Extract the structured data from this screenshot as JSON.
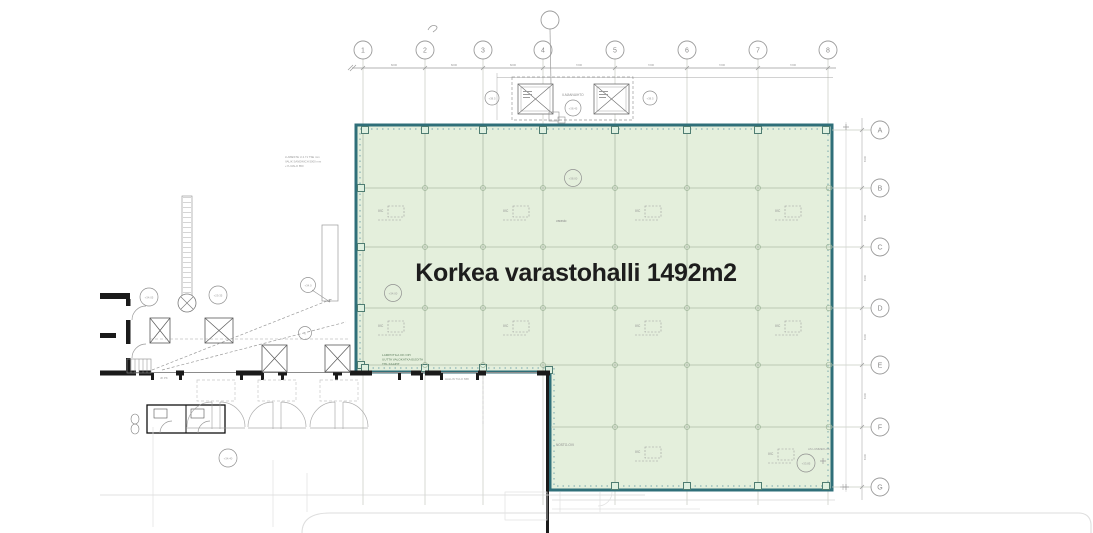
{
  "plan": {
    "highlight_label": "Korkea varastohalli 1492m2",
    "highlight_fill": "#e4efdc",
    "highlight_border": "#2f6f79",
    "iv_unit_label": "IVC"
  },
  "grid": {
    "top_labels": [
      "1",
      "2",
      "3",
      "4",
      "5",
      "6",
      "7",
      "8"
    ],
    "aux_label": "",
    "side_labels": [
      "A",
      "B",
      "C",
      "D",
      "E",
      "F",
      "G"
    ]
  },
  "dimensions": {
    "top": [
      "6000",
      "6000",
      "6000",
      "7200",
      "7200",
      "7200",
      "7200"
    ],
    "right": [
      "8100",
      "8100",
      "8100",
      "8100",
      "8100",
      "8100"
    ]
  },
  "elevations": {
    "roof_center": "+38.45",
    "roof_left": "+38.5",
    "roof_right": "+38.5",
    "hall_upper": "+38.00",
    "hall_left": "+34.00",
    "corridor_a": "+34.05",
    "corridor_b": "+29.35",
    "corridor_c": "+34.0",
    "yard": "+34.40",
    "dock": "+33.85"
  },
  "annotations": {
    "note_left_1": "LUMIESTE U 4.71 TSE mm",
    "note_left_2": "VALIK SANDWICH 5000 mm",
    "note_left_3": "+YLIVALO 850",
    "note_green_1": "LAMPOTILA OK OPI",
    "note_green_2": "UUTTA VALOKATKAISIJOITA",
    "note_green_3": "THL KAAPIT",
    "roof_center_label": "ILMANVAIHTO",
    "wall_note": "HALLIN TULO S58",
    "dock_note": "AS LUMMEKUJA",
    "room_note": "JK PK",
    "door_note": "NOSTO-OVI",
    "varasto": "varasto",
    "small_six": "6"
  }
}
